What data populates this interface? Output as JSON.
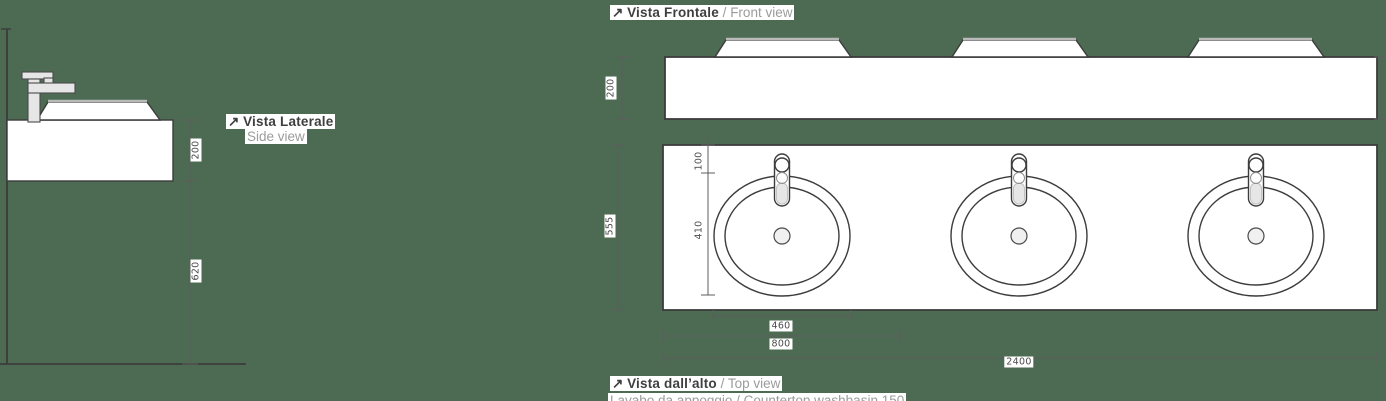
{
  "colors": {
    "background": "#4d6b52",
    "line": "#3c3c3c",
    "label_dark": "#3f3f3f",
    "label_muted": "#9b9b9b"
  },
  "labels": {
    "front": {
      "arrow": "↗",
      "it": "Vista Frontale",
      "sep": " / ",
      "en": "Front view"
    },
    "side": {
      "arrow": "↗",
      "it": "Vista Laterale",
      "en": "Side view"
    },
    "top": {
      "arrow": "↗",
      "it": "Vista dall’alto",
      "sep": " / ",
      "en": "Top view"
    },
    "truncated_caption": "Lavabo da appoggio / Countertop washbasin 150"
  },
  "dimensions": {
    "side": {
      "cabinet_height": "200",
      "floor_clearance": "620"
    },
    "front": {
      "cabinet_height": "200"
    },
    "top": {
      "depth": "555",
      "faucet_offset": "100",
      "basin_length": "410",
      "basin_width": "460",
      "module_width": "800",
      "total_width": "2400"
    }
  }
}
